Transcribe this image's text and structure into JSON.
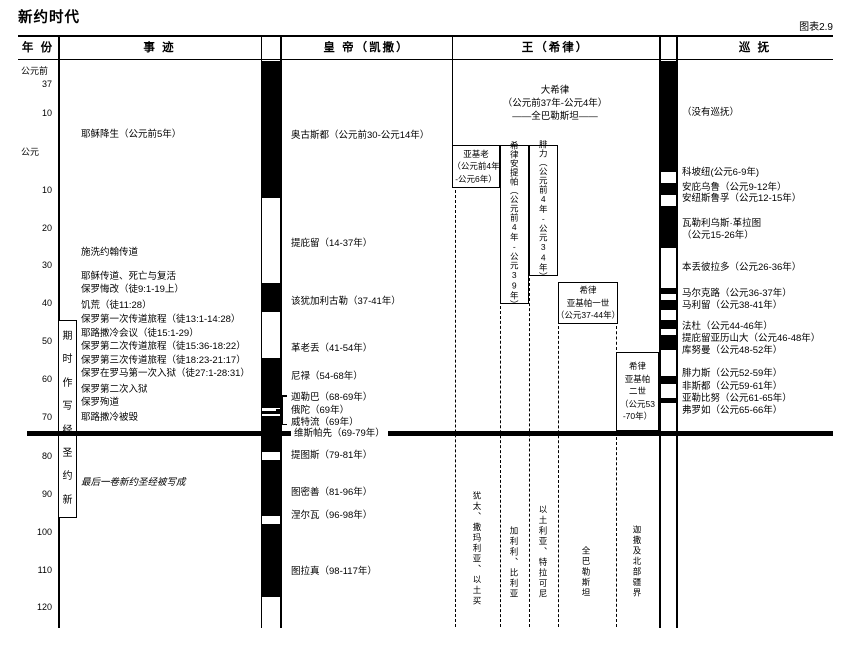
{
  "meta": {
    "title": "新约时代",
    "figure_label": "图表2.9"
  },
  "colors": {
    "ink": "#000000",
    "paper": "#ffffff"
  },
  "header": {
    "columns": [
      {
        "label": "年 份"
      },
      {
        "label": "事 迹"
      },
      {
        "label": "皇 帝（凯撒）"
      },
      {
        "label": "王（希律）"
      },
      {
        "label": "巡 抚"
      }
    ]
  },
  "chart_data": {
    "type": "timeline",
    "title": "新约时代",
    "figure_label": "图表2.9",
    "axis": {
      "label": "年份",
      "era_labels": [
        "公元前",
        "公元"
      ],
      "tick_years": [
        -37,
        -10,
        0,
        10,
        20,
        30,
        40,
        50,
        60,
        70,
        80,
        90,
        100,
        110,
        120
      ],
      "orientation": "vertical-top-to-bottom"
    },
    "year_ticks": [
      {
        "text": "公元前",
        "top": 66,
        "cls": "era"
      },
      {
        "text": "37",
        "top": 79
      },
      {
        "text": "10",
        "top": 108
      },
      {
        "text": "公元",
        "top": 147,
        "cls": "era"
      },
      {
        "text": "10",
        "top": 185
      },
      {
        "text": "20",
        "top": 223
      },
      {
        "text": "30",
        "top": 260
      },
      {
        "text": "40",
        "top": 298
      },
      {
        "text": "50",
        "top": 336
      },
      {
        "text": "60",
        "top": 374
      },
      {
        "text": "70",
        "top": 412
      },
      {
        "text": "80",
        "top": 451
      },
      {
        "text": "90",
        "top": 489
      },
      {
        "text": "100",
        "top": 527
      },
      {
        "text": "110",
        "top": 565
      },
      {
        "text": "120",
        "top": 602
      }
    ],
    "events": [
      {
        "text": "耶稣降生（公元前5年）",
        "top": 129,
        "year": -5
      },
      {
        "text": "施洗约翰传道",
        "top": 247
      },
      {
        "text": "耶稣传道、死亡与复活",
        "top": 271
      },
      {
        "text": "保罗悔改（徒9:1-19上）",
        "top": 284
      },
      {
        "text": "饥荒（徒11:28）",
        "top": 300
      },
      {
        "text": "保罗第一次传道旅程（徒13:1-14:28）",
        "top": 314
      },
      {
        "text": "耶路撒冷会议（徒15:1-29）",
        "top": 328
      },
      {
        "text": "保罗第二次传道旅程（徒15:36-18:22）",
        "top": 341
      },
      {
        "text": "保罗第三次传道旅程（徒18:23-21:17）",
        "top": 355
      },
      {
        "text": "保罗在罗马第一次入狱（徒27:1-28:31）",
        "top": 368
      },
      {
        "text": "保罗第二次入狱",
        "top": 384
      },
      {
        "text": "保罗殉道",
        "top": 397
      },
      {
        "text": "耶路撒冷被毁",
        "top": 412,
        "year": 70
      },
      {
        "text": "最后一卷新约圣经被写成",
        "top": 478,
        "cls": "italic"
      }
    ],
    "scripture_period": {
      "label": "新约圣经写作时期",
      "reading_direction": "bottom-to-top",
      "display_chars": [
        {
          "text": "期"
        },
        {
          "text": "时"
        },
        {
          "text": "作"
        },
        {
          "text": "写"
        },
        {
          "text": "经"
        },
        {
          "text": "圣"
        },
        {
          "text": "约"
        },
        {
          "text": "新"
        }
      ]
    },
    "emperors": {
      "items": [
        {
          "text": "奥古斯都（公元前30-公元14年）",
          "top": 130,
          "start": -30,
          "end": 14
        },
        {
          "text": "提庇留（14-37年）",
          "top": 238,
          "start": 14,
          "end": 37
        },
        {
          "text": "该犹加利古勒（37-41年）",
          "top": 296,
          "start": 37,
          "end": 41
        },
        {
          "text": "革老丢（41-54年）",
          "top": 343,
          "start": 41,
          "end": 54
        },
        {
          "text": "尼禄（54-68年）",
          "top": 371,
          "start": 54,
          "end": 68
        },
        {
          "text": "迦勒巴（68-69年）",
          "top": 392,
          "start": 68,
          "end": 69
        },
        {
          "text": "俄陀（69年）",
          "top": 405,
          "start": 69,
          "end": 69
        },
        {
          "text": "威特流（69年）",
          "top": 417,
          "start": 69,
          "end": 69
        },
        {
          "text": "维斯帕先（69-79年）",
          "top": 428,
          "start": 69,
          "end": 79,
          "cls": "onpatch"
        },
        {
          "text": "提图斯（79-81年）",
          "top": 450,
          "start": 79,
          "end": 81
        },
        {
          "text": "图密善（81-96年）",
          "top": 487,
          "start": 81,
          "end": 96
        },
        {
          "text": "涅尔瓦（96-98年）",
          "top": 510,
          "start": 96,
          "end": 98
        },
        {
          "text": "图拉真（98-117年）",
          "top": 566,
          "start": 98,
          "end": 117
        }
      ],
      "bar_black": [
        {
          "top": 61,
          "height": 137
        },
        {
          "top": 283,
          "height": 29
        },
        {
          "top": 358,
          "height": 50
        },
        {
          "top": 411,
          "height": 3
        },
        {
          "top": 416,
          "height": 36
        },
        {
          "top": 460,
          "height": 56
        },
        {
          "top": 524,
          "height": 73
        }
      ]
    },
    "governors": {
      "items": [
        {
          "text": "（没有巡抚）",
          "top": 107
        },
        {
          "text": "科坡纽(公元6-9年)",
          "top": 167,
          "start": 6,
          "end": 9
        },
        {
          "text": "安庇乌鲁（公元9-12年）",
          "top": 182,
          "start": 9,
          "end": 12
        },
        {
          "text": "安纽斯鲁孚（公元12-15年）",
          "top": 193,
          "start": 12,
          "end": 15
        },
        {
          "text": "瓦勒利乌斯·革拉图",
          "top": 218,
          "start": 15,
          "end": 26
        },
        {
          "text": "（公元15-26年）",
          "top": 230
        },
        {
          "text": "本丢彼拉多（公元26-36年）",
          "top": 262,
          "start": 26,
          "end": 36
        },
        {
          "text": "马尔克路（公元36-37年）",
          "top": 288,
          "start": 36,
          "end": 37
        },
        {
          "text": "马利留（公元38-41年）",
          "top": 300,
          "start": 38,
          "end": 41
        },
        {
          "text": "法杜（公元44-46年）",
          "top": 321,
          "start": 44,
          "end": 46
        },
        {
          "text": "提庇留亚历山大（公元46-48年）",
          "top": 333,
          "start": 46,
          "end": 48
        },
        {
          "text": "库努曼（公元48-52年）",
          "top": 345,
          "start": 48,
          "end": 52
        },
        {
          "text": "腓力斯（公元52-59年）",
          "top": 368,
          "start": 52,
          "end": 59
        },
        {
          "text": "非斯都（公元59-61年）",
          "top": 381,
          "start": 59,
          "end": 61
        },
        {
          "text": "亚勒比努（公元61-65年）",
          "top": 393,
          "start": 61,
          "end": 65
        },
        {
          "text": "弗罗如（公元65-66年）",
          "top": 405,
          "start": 65,
          "end": 66
        }
      ],
      "bar_black": [
        {
          "top": 61,
          "height": 111
        },
        {
          "top": 183,
          "height": 12
        },
        {
          "top": 206,
          "height": 42
        },
        {
          "top": 288,
          "height": 6
        },
        {
          "top": 300,
          "height": 10
        },
        {
          "top": 320,
          "height": 9
        },
        {
          "top": 335,
          "height": 15
        },
        {
          "top": 376,
          "height": 8
        },
        {
          "top": 398,
          "height": 5
        }
      ]
    },
    "kings": {
      "herod_great_lines": [
        {
          "text": "大希律",
          "top": 85
        },
        {
          "text": "（公元前37年-公元4年）",
          "top": 98
        },
        {
          "text": "——全巴勒斯坦——",
          "top": 111
        }
      ],
      "boxes": [
        {
          "name": "archelaus",
          "left": 452,
          "top": 145,
          "width": 48,
          "height": 43,
          "start": -4,
          "end": 6,
          "lines": [
            "亚基老",
            "（公元前4年",
            "-公元6年）"
          ]
        },
        {
          "name": "antipas",
          "left": 499.5,
          "top": 145,
          "width": 29,
          "height": 159,
          "start": -4,
          "end": 39,
          "text": "希律安提帕（公元前4年-公元39年）",
          "cls": "vbox"
        },
        {
          "name": "philip",
          "left": 528.5,
          "top": 145,
          "width": 29,
          "height": 131,
          "start": -4,
          "end": 34,
          "text": "腓力（公元前4年-公元34年）",
          "cls": "vbox"
        },
        {
          "name": "agrippa1",
          "left": 558,
          "top": 282,
          "width": 60,
          "height": 42,
          "start": 37,
          "end": 44,
          "lines": [
            "希律",
            "亚基帕一世",
            "（公元37-44年）"
          ]
        },
        {
          "name": "agrippa2",
          "left": 616,
          "top": 352,
          "width": 43,
          "height": 79,
          "start": 53,
          "end": 70,
          "lines": [
            "希律",
            "亚基帕",
            "二世",
            "（公元53",
            "-70年）"
          ]
        }
      ],
      "territories": [
        {
          "text": "犹太、撒玛利亚、以土买",
          "left": 471,
          "top": 491
        },
        {
          "text": "加利利、比利亚",
          "left": 508,
          "top": 526
        },
        {
          "text": "以土利亚、特拉可尼",
          "left": 537,
          "top": 505
        },
        {
          "text": "全巴勒斯坦",
          "left": 580,
          "top": 546
        },
        {
          "text": "迦撒及北部疆界",
          "left": 631,
          "top": 525
        }
      ],
      "dashed_lines": [
        {
          "left": 455,
          "top": 190,
          "height": 437
        },
        {
          "left": 500,
          "top": 306,
          "height": 321
        },
        {
          "left": 529,
          "top": 278,
          "height": 349
        },
        {
          "left": 558,
          "top": 326,
          "height": 301
        },
        {
          "left": 616,
          "top": 326,
          "height": 24
        },
        {
          "left": 616,
          "top": 437,
          "height": 190
        }
      ]
    },
    "grid_lines": [
      {
        "left": 18,
        "top": 35,
        "width": 815,
        "height": 2
      },
      {
        "left": 18,
        "top": 58.5,
        "width": 815,
        "height": 1.5
      },
      {
        "left": 58,
        "top": 35,
        "width": 1.5,
        "height": 593
      },
      {
        "left": 260.5,
        "top": 35,
        "width": 1.5,
        "height": 593
      },
      {
        "left": 280,
        "top": 35,
        "width": 1.5,
        "height": 593
      },
      {
        "left": 451.5,
        "top": 35,
        "width": 1.5,
        "height": 111
      },
      {
        "left": 659,
        "top": 35,
        "width": 1.5,
        "height": 593
      },
      {
        "left": 676,
        "top": 35,
        "width": 1.5,
        "height": 593
      }
    ],
    "bracket_segments": [
      {
        "left": 281,
        "top": 395,
        "width": 1.5,
        "height": 30
      },
      {
        "left": 281,
        "top": 395,
        "width": 6,
        "height": 1.5
      },
      {
        "left": 275.5,
        "top": 409,
        "width": 6,
        "height": 1.5
      },
      {
        "left": 281,
        "top": 423.5,
        "width": 6,
        "height": 1.5
      }
    ],
    "divider_line": {
      "year": 70,
      "left": 27,
      "top": 431,
      "width": 806,
      "height": 4.5
    }
  }
}
